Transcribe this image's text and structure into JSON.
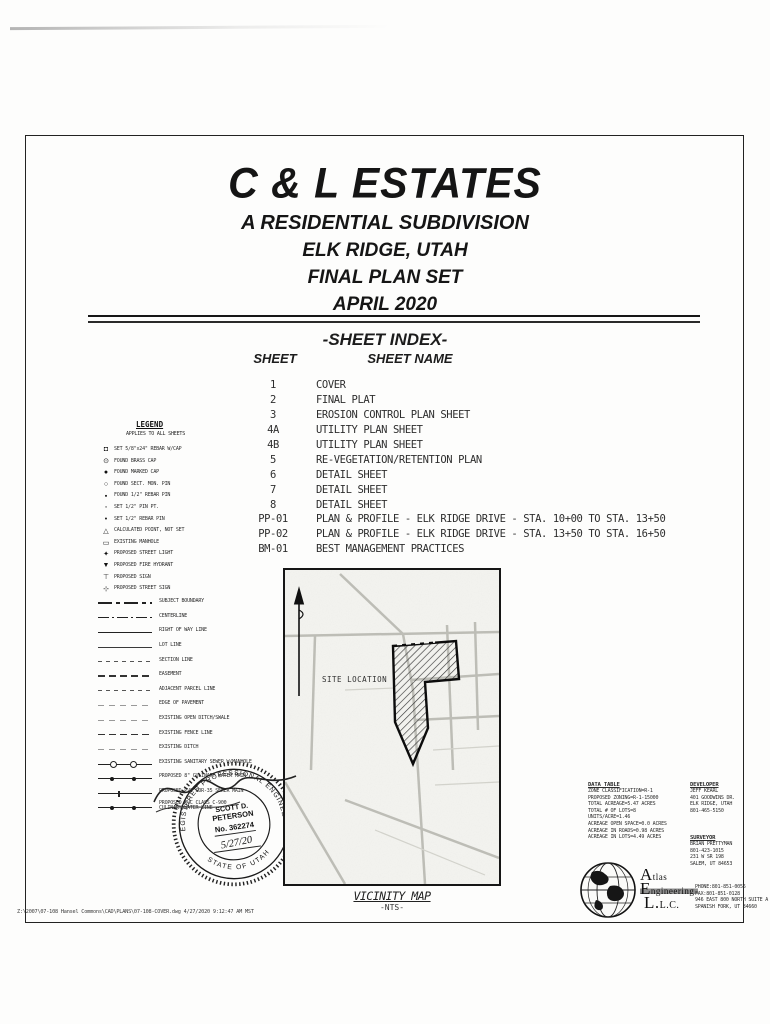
{
  "title_block": {
    "title": "C & L ESTATES",
    "subtitle1": "A RESIDENTIAL SUBDIVISION",
    "subtitle2": "ELK RIDGE, UTAH",
    "subtitle3": "FINAL PLAN SET",
    "subtitle4": "APRIL 2020"
  },
  "sheet_index": {
    "heading": "-SHEET INDEX-",
    "col_sheet": "SHEET",
    "col_name": "SHEET NAME",
    "rows": [
      {
        "no": "1",
        "name": "COVER"
      },
      {
        "no": "2",
        "name": "FINAL PLAT"
      },
      {
        "no": "3",
        "name": "EROSION CONTROL PLAN SHEET"
      },
      {
        "no": "4A",
        "name": "UTILITY PLAN SHEET"
      },
      {
        "no": "4B",
        "name": "UTILITY PLAN SHEET"
      },
      {
        "no": "5",
        "name": "RE-VEGETATION/RETENTION PLAN"
      },
      {
        "no": "6",
        "name": "DETAIL SHEET"
      },
      {
        "no": "7",
        "name": "DETAIL SHEET"
      },
      {
        "no": "8",
        "name": "DETAIL SHEET"
      },
      {
        "no": "PP-01",
        "name": "PLAN & PROFILE - ELK RIDGE DRIVE - STA. 10+00 TO STA. 13+50"
      },
      {
        "no": "PP-02",
        "name": "PLAN & PROFILE - ELK RIDGE DRIVE - STA. 13+50 TO STA. 16+50"
      },
      {
        "no": "BM-01",
        "name": "BEST MANAGEMENT PRACTICES"
      }
    ]
  },
  "legend": {
    "heading": "LEGEND",
    "subheading": "APPLIES TO ALL SHEETS",
    "symbol_items": [
      {
        "symbol": "◘",
        "label": "SET 5/8\"x24\" REBAR W/CAP"
      },
      {
        "symbol": "⊙",
        "label": "FOUND BRASS CAP"
      },
      {
        "symbol": "●",
        "label": "FOUND MARKED CAP"
      },
      {
        "symbol": "○",
        "label": "FOUND SECT. MON. PIN"
      },
      {
        "symbol": "▪",
        "label": "FOUND 1/2\" REBAR PIN"
      },
      {
        "symbol": "◦",
        "label": "SET 1/2\" PIN PT."
      },
      {
        "symbol": "•",
        "label": "SET 1/2\" REBAR PIN"
      },
      {
        "symbol": "△",
        "label": "CALCULATED POINT, NOT SET"
      },
      {
        "symbol": "▭",
        "label": "EXISTING MANHOLE"
      },
      {
        "symbol": "✦",
        "label": "PROPOSED STREET LIGHT"
      },
      {
        "symbol": "▼",
        "label": "PROPOSED FIRE HYDRANT"
      },
      {
        "symbol": "⊤",
        "label": "PROPOSED SIGN"
      },
      {
        "symbol": "⊹",
        "label": "PROPOSED STREET SIGN"
      }
    ],
    "line_items": [
      {
        "style": "dashlong",
        "label": "SUBJECT BOUNDARY"
      },
      {
        "style": "dashdot",
        "label": "CENTERLINE"
      },
      {
        "style": "solid",
        "label": "RIGHT OF WAY LINE"
      },
      {
        "style": "thin",
        "label": "LOT LINE"
      },
      {
        "style": "dashtiny",
        "label": "SECTION LINE"
      },
      {
        "style": "dashed",
        "label": "EASEMENT"
      },
      {
        "style": "dashtiny",
        "label": "ADJACENT PARCEL LINE"
      },
      {
        "style": "faint",
        "label": "EDGE OF PAVEMENT"
      },
      {
        "style": "faint",
        "label": "EXISTING OPEN DITCH/SWALE"
      },
      {
        "style": "dashed",
        "label": "EXISTING FENCE LINE"
      },
      {
        "style": "faint",
        "label": "EXISTING DITCH"
      },
      {
        "style": "mh",
        "label": "EXISTING SANITARY SEWER W/MANHOLE"
      },
      {
        "style": "mhf",
        "label": "PROPOSED 8\" CULINARY WATER MAIN"
      },
      {
        "style": "tick",
        "label": "PROPOSED PVC SDR-35 SEWER MAIN"
      },
      {
        "style": "mhf",
        "label": "PROPOSED PVC CLASS C-900\nCULINARY WATER LINE"
      }
    ]
  },
  "vicinity_map": {
    "site_label": "SITE LOCATION",
    "caption": "VICINITY MAP",
    "scale": "-NTS-"
  },
  "stamp": {
    "ring_top": "REGISTERED PROFESSIONAL ENGINEER",
    "ring_bottom": "STATE OF UTAH",
    "name_line1": "SCOTT D.",
    "name_line2": "PETERSON",
    "number": "No. 362274",
    "date": "5/27/20"
  },
  "data_table": {
    "heading": "DATA TABLE",
    "lines": [
      "ZONE CLASSIFICATION=R-1",
      "PROPOSED ZONING=R-1-15000",
      "TOTAL ACREAGE=5.47 ACRES",
      "TOTAL # OF LOTS=8",
      "UNITS/ACRE=1.46",
      "ACREAGE OPEN SPACE=0.0 ACRES",
      "ACREAGE IN ROADS=0.98 ACRES",
      "ACREAGE IN LOTS=4.49 ACRES"
    ]
  },
  "developer": {
    "heading": "DEVELOPER",
    "lines": [
      "JEFF KEARL",
      "401 GOODWINS DR.",
      "ELK RIDGE, UTAH",
      "801-465-5150"
    ]
  },
  "surveyor": {
    "heading": "SURVEYOR",
    "lines": [
      "BRIAN PRETTYMAN",
      "801-423-1015",
      "231 W SR 198",
      "SALEM, UT 84653"
    ]
  },
  "engineering_firm": {
    "name_line1": "Atlas",
    "name_line2": "Engineering",
    "name_line3": "L.L.C.",
    "contact_lines": [
      "PHONE:801-851-0056",
      "FAX:801-851-0128",
      "946 EAST 800 NORTH SUITE A",
      "SPANISH FORK, UT 84660"
    ]
  },
  "footer": {
    "plot_stamp": "Z:\\2007\\07-108 Hansel Commons\\CAD\\PLANS\\07-108-COVER.dwg  4/27/2020  9:12:47 AM MST"
  }
}
